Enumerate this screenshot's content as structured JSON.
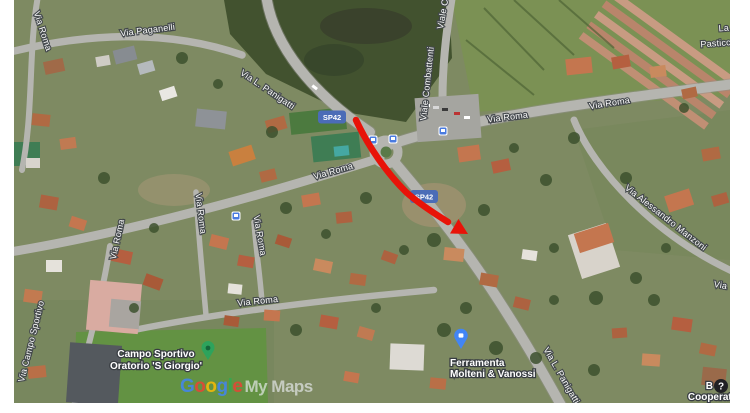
{
  "map": {
    "type": "satellite",
    "street_labels": [
      {
        "id": "via-roma-nw",
        "text": "Via Roma"
      },
      {
        "id": "via-paganelli",
        "text": "Via Paganelli"
      },
      {
        "id": "via-l-panigatti",
        "text": "Via L. Panigatti"
      },
      {
        "id": "viale-combattenti-upper",
        "text": "Viale Co"
      },
      {
        "id": "viale-combattenti",
        "text": "Viale Combattenti"
      },
      {
        "id": "via-roma-east-1",
        "text": "Via Roma"
      },
      {
        "id": "via-roma-east-2",
        "text": "Via Roma"
      },
      {
        "id": "la-partial",
        "text": "La"
      },
      {
        "id": "pasticceria-partial",
        "text": "Pasticcer"
      },
      {
        "id": "via-roma-center",
        "text": "Via Roma"
      },
      {
        "id": "via-roma-w1",
        "text": "Via Roma"
      },
      {
        "id": "via-roma-w2",
        "text": "Via Roma"
      },
      {
        "id": "via-roma-w3",
        "text": "Via Roma"
      },
      {
        "id": "via-roma-south",
        "text": "Via Roma"
      },
      {
        "id": "via-campo-sportivo",
        "text": "Via Campo Sportivo"
      },
      {
        "id": "via-alessandro-manzoni",
        "text": "Via Alessandro Manzoni"
      },
      {
        "id": "via-l-panigatti-south",
        "text": "Via L. Panigatti"
      },
      {
        "id": "via-east-edge",
        "text": "Via"
      }
    ],
    "road_shields": {
      "color": "#4b6cb7",
      "items": [
        {
          "text": "SP42"
        },
        {
          "text": "SP42"
        }
      ]
    },
    "route": {
      "color": "#e81309"
    },
    "pois": [
      {
        "id": "campo-sportivo",
        "line1": "Campo Sportivo",
        "line2": "Oratorio 'S Giorgio'",
        "pin": "green-pin-icon",
        "pin_color": "#2da35c"
      },
      {
        "id": "ferramenta",
        "line1": "Ferramenta",
        "line2": "Molteni & Vanossi",
        "pin": "blue-pin-icon",
        "pin_color": "#4285f4"
      },
      {
        "id": "cooperativa",
        "line1": "B",
        "line2": "Cooperativ",
        "pin": "question-mark-icon",
        "pin_color": "#202124",
        "question_glyph": "?"
      }
    ],
    "transit_icons": {
      "name": "bus-stop-icon",
      "color": "#4a7be0"
    }
  },
  "watermark": {
    "google": [
      {
        "ch": "G",
        "color": "#4285F4"
      },
      {
        "ch": "o",
        "color": "#EA4335"
      },
      {
        "ch": "o",
        "color": "#FBBC05"
      },
      {
        "ch": "g",
        "color": "#4285F4"
      },
      {
        "ch": "l",
        "color": "#34A853"
      },
      {
        "ch": "e",
        "color": "#EA4335"
      }
    ],
    "suffix": "My Maps",
    "suffix_color": "#e8eaed"
  }
}
